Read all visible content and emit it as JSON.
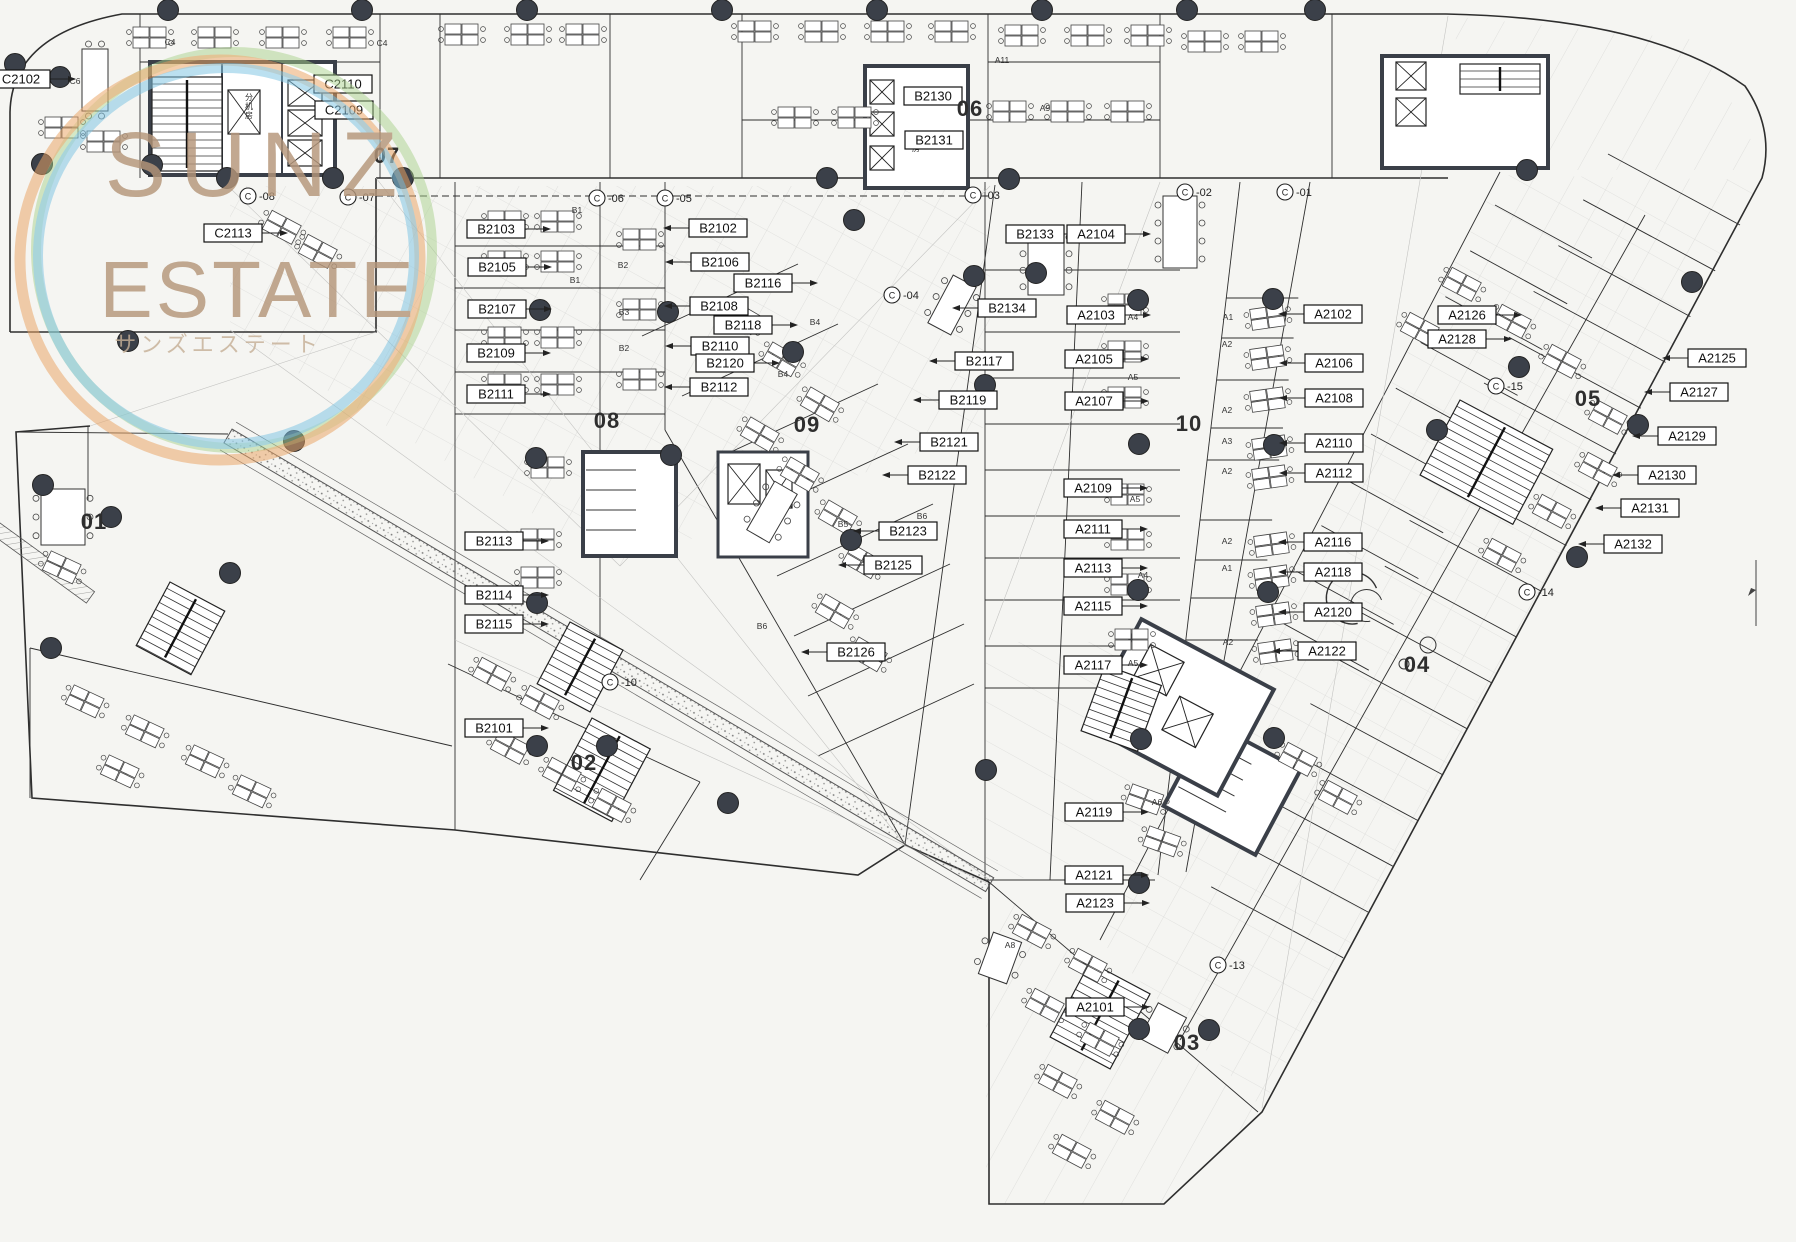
{
  "watermark": {
    "line1": "SUNZ",
    "line2": "ESTATE",
    "line3": "サンズエステート",
    "text_color": "#b5967a",
    "ring_orange": "#e9a566",
    "ring_blue": "#7fc4e4",
    "ring_green": "#a8d28c"
  },
  "colors": {
    "paper": "#f5f5f2",
    "line": "#2e2e2e",
    "column_dot": "#3b4049",
    "wall_dark": "#3a3f48"
  },
  "zone_numbers": [
    {
      "n": "01",
      "x": 94,
      "y": 529
    },
    {
      "n": "02",
      "x": 584,
      "y": 770
    },
    {
      "n": "03",
      "x": 1187,
      "y": 1050
    },
    {
      "n": "04",
      "x": 1417,
      "y": 672
    },
    {
      "n": "05",
      "x": 1588,
      "y": 406
    },
    {
      "n": "06",
      "x": 970,
      "y": 116
    },
    {
      "n": "07",
      "x": 387,
      "y": 163
    },
    {
      "n": "08",
      "x": 607,
      "y": 428
    },
    {
      "n": "09",
      "x": 807,
      "y": 432
    },
    {
      "n": "10",
      "x": 1189,
      "y": 431
    }
  ],
  "room_labels": [
    {
      "t": "C2102",
      "x": 21,
      "y": 79,
      "d": "r"
    },
    {
      "t": "C2110",
      "x": 343,
      "y": 84,
      "d": "n"
    },
    {
      "t": "C2109",
      "x": 344,
      "y": 110,
      "d": "n"
    },
    {
      "t": "C2113",
      "x": 233,
      "y": 233,
      "d": "r"
    },
    {
      "t": "B2103",
      "x": 496,
      "y": 229,
      "d": "r"
    },
    {
      "t": "B2105",
      "x": 497,
      "y": 267,
      "d": "r"
    },
    {
      "t": "B2107",
      "x": 497,
      "y": 309,
      "d": "r"
    },
    {
      "t": "B2109",
      "x": 496,
      "y": 353,
      "d": "r"
    },
    {
      "t": "B2111",
      "x": 496,
      "y": 394,
      "d": "r"
    },
    {
      "t": "B2102",
      "x": 718,
      "y": 228,
      "d": "l"
    },
    {
      "t": "B2106",
      "x": 720,
      "y": 262,
      "d": "l"
    },
    {
      "t": "B2116",
      "x": 763,
      "y": 283,
      "d": "r"
    },
    {
      "t": "B2108",
      "x": 719,
      "y": 306,
      "d": "l"
    },
    {
      "t": "B2118",
      "x": 743,
      "y": 325,
      "d": "r"
    },
    {
      "t": "B2110",
      "x": 720,
      "y": 346,
      "d": "l"
    },
    {
      "t": "B2120",
      "x": 725,
      "y": 363,
      "d": "r"
    },
    {
      "t": "B2112",
      "x": 719,
      "y": 387,
      "d": "l"
    },
    {
      "t": "B2130",
      "x": 933,
      "y": 96,
      "d": "n"
    },
    {
      "t": "B2131",
      "x": 934,
      "y": 140,
      "d": "n"
    },
    {
      "t": "B2133",
      "x": 1035,
      "y": 234,
      "d": "r"
    },
    {
      "t": "B2134",
      "x": 1007,
      "y": 308,
      "d": "l"
    },
    {
      "t": "B2117",
      "x": 984,
      "y": 361,
      "d": "l"
    },
    {
      "t": "B2119",
      "x": 968,
      "y": 400,
      "d": "l"
    },
    {
      "t": "B2121",
      "x": 949,
      "y": 442,
      "d": "l"
    },
    {
      "t": "B2122",
      "x": 937,
      "y": 475,
      "d": "l"
    },
    {
      "t": "B2123",
      "x": 908,
      "y": 531,
      "d": "l"
    },
    {
      "t": "B2125",
      "x": 893,
      "y": 565,
      "d": "l"
    },
    {
      "t": "B2126",
      "x": 856,
      "y": 652,
      "d": "l"
    },
    {
      "t": "B2113",
      "x": 494,
      "y": 541,
      "d": "r"
    },
    {
      "t": "B2114",
      "x": 494,
      "y": 595,
      "d": "r"
    },
    {
      "t": "B2115",
      "x": 494,
      "y": 624,
      "d": "r"
    },
    {
      "t": "B2101",
      "x": 494,
      "y": 728,
      "d": "r"
    },
    {
      "t": "A2104",
      "x": 1096,
      "y": 234,
      "d": "r"
    },
    {
      "t": "A2103",
      "x": 1096,
      "y": 315,
      "d": "r"
    },
    {
      "t": "A2105",
      "x": 1094,
      "y": 359,
      "d": "r"
    },
    {
      "t": "A2107",
      "x": 1094,
      "y": 401,
      "d": "r"
    },
    {
      "t": "A2109",
      "x": 1093,
      "y": 488,
      "d": "r"
    },
    {
      "t": "A2111",
      "x": 1093,
      "y": 529,
      "d": "r"
    },
    {
      "t": "A2113",
      "x": 1093,
      "y": 568,
      "d": "r"
    },
    {
      "t": "A2115",
      "x": 1093,
      "y": 606,
      "d": "r"
    },
    {
      "t": "A2117",
      "x": 1093,
      "y": 665,
      "d": "r"
    },
    {
      "t": "A2119",
      "x": 1094,
      "y": 812,
      "d": "r"
    },
    {
      "t": "A2121",
      "x": 1094,
      "y": 875,
      "d": "r"
    },
    {
      "t": "A2123",
      "x": 1095,
      "y": 903,
      "d": "r"
    },
    {
      "t": "A2101",
      "x": 1095,
      "y": 1007,
      "d": "r"
    },
    {
      "t": "A2102",
      "x": 1333,
      "y": 314,
      "d": "l"
    },
    {
      "t": "A2106",
      "x": 1334,
      "y": 363,
      "d": "l"
    },
    {
      "t": "A2108",
      "x": 1334,
      "y": 398,
      "d": "l"
    },
    {
      "t": "A2110",
      "x": 1334,
      "y": 443,
      "d": "l"
    },
    {
      "t": "A2112",
      "x": 1334,
      "y": 473,
      "d": "l"
    },
    {
      "t": "A2116",
      "x": 1333,
      "y": 542,
      "d": "l"
    },
    {
      "t": "A2118",
      "x": 1333,
      "y": 572,
      "d": "l"
    },
    {
      "t": "A2120",
      "x": 1333,
      "y": 612,
      "d": "l"
    },
    {
      "t": "A2122",
      "x": 1327,
      "y": 651,
      "d": "l"
    },
    {
      "t": "A2126",
      "x": 1467,
      "y": 315,
      "d": "r"
    },
    {
      "t": "A2128",
      "x": 1457,
      "y": 339,
      "d": "r"
    },
    {
      "t": "A2125",
      "x": 1717,
      "y": 358,
      "d": "l"
    },
    {
      "t": "A2127",
      "x": 1699,
      "y": 392,
      "d": "l"
    },
    {
      "t": "A2129",
      "x": 1687,
      "y": 436,
      "d": "l"
    },
    {
      "t": "A2130",
      "x": 1667,
      "y": 475,
      "d": "l"
    },
    {
      "t": "A2131",
      "x": 1650,
      "y": 508,
      "d": "l"
    },
    {
      "t": "A2132",
      "x": 1633,
      "y": 544,
      "d": "l"
    }
  ],
  "grid_markers": [
    {
      "t": "-08",
      "x": 248,
      "y": 196
    },
    {
      "t": "-07",
      "x": 348,
      "y": 197
    },
    {
      "t": "-06",
      "x": 597,
      "y": 198
    },
    {
      "t": "-05",
      "x": 665,
      "y": 198
    },
    {
      "t": "-04",
      "x": 892,
      "y": 295
    },
    {
      "t": "-03",
      "x": 973,
      "y": 195
    },
    {
      "t": "-02",
      "x": 1185,
      "y": 192
    },
    {
      "t": "-01",
      "x": 1285,
      "y": 192
    },
    {
      "t": "-10",
      "x": 610,
      "y": 682
    },
    {
      "t": "-13",
      "x": 1218,
      "y": 965
    },
    {
      "t": "-14",
      "x": 1527,
      "y": 592
    },
    {
      "t": "-15",
      "x": 1496,
      "y": 386
    }
  ],
  "machine_rooms": [
    {
      "t": "分机房",
      "x": 249,
      "y": 100
    },
    {
      "t": "机房",
      "x": 916,
      "y": 142
    }
  ],
  "sub_room_labels": [
    {
      "t": "C4",
      "x": 170,
      "y": 45
    },
    {
      "t": "C4",
      "x": 382,
      "y": 46
    },
    {
      "t": "C6",
      "x": 75,
      "y": 84
    },
    {
      "t": "B1",
      "x": 577,
      "y": 213
    },
    {
      "t": "B1",
      "x": 575,
      "y": 283
    },
    {
      "t": "B2",
      "x": 623,
      "y": 268
    },
    {
      "t": "B3",
      "x": 624,
      "y": 315
    },
    {
      "t": "B2",
      "x": 624,
      "y": 351
    },
    {
      "t": "B4",
      "x": 815,
      "y": 325
    },
    {
      "t": "B4",
      "x": 783,
      "y": 377
    },
    {
      "t": "B5",
      "x": 843,
      "y": 527
    },
    {
      "t": "B6",
      "x": 922,
      "y": 519
    },
    {
      "t": "B3",
      "x": 868,
      "y": 563
    },
    {
      "t": "B6",
      "x": 762,
      "y": 629
    },
    {
      "t": "A4",
      "x": 1133,
      "y": 320
    },
    {
      "t": "A5",
      "x": 1133,
      "y": 380
    },
    {
      "t": "A5",
      "x": 1135,
      "y": 502
    },
    {
      "t": "A4",
      "x": 1143,
      "y": 578
    },
    {
      "t": "A5",
      "x": 1133,
      "y": 666
    },
    {
      "t": "A1",
      "x": 1228,
      "y": 320
    },
    {
      "t": "A2",
      "x": 1227,
      "y": 347
    },
    {
      "t": "A2",
      "x": 1227,
      "y": 413
    },
    {
      "t": "A3",
      "x": 1227,
      "y": 444
    },
    {
      "t": "A2",
      "x": 1227,
      "y": 474
    },
    {
      "t": "A2",
      "x": 1227,
      "y": 544
    },
    {
      "t": "A1",
      "x": 1227,
      "y": 571
    },
    {
      "t": "A2",
      "x": 1228,
      "y": 645
    },
    {
      "t": "A6",
      "x": 1157,
      "y": 805
    },
    {
      "t": "A11",
      "x": 1002,
      "y": 63
    },
    {
      "t": "A9",
      "x": 1045,
      "y": 111
    },
    {
      "t": "A8",
      "x": 1010,
      "y": 948
    }
  ]
}
